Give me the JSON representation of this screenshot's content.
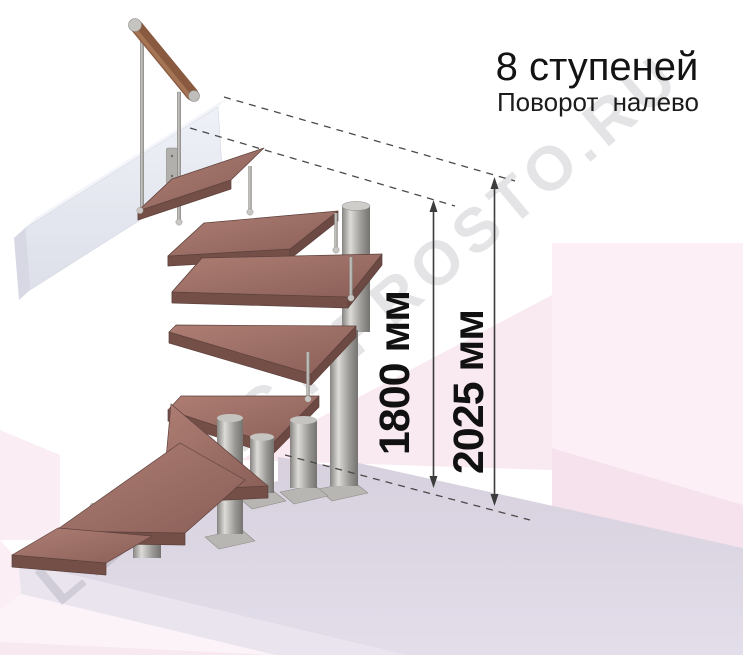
{
  "header": {
    "title": "8 ступеней",
    "subtitle": "Поворот налево"
  },
  "diagram": {
    "steps_shown": 8,
    "turn_direction": "налево",
    "dimensions": [
      {
        "id": "height-to-top-step",
        "label": "1800 мм"
      },
      {
        "id": "height-to-landing",
        "label": "2025 мм"
      }
    ]
  },
  "watermark": {
    "text": "LESTNICY-PROSTO.RU"
  },
  "colors": {
    "wood_top": "#9e7067",
    "wood_edge": "#744f48",
    "metal": "#a8a6a2",
    "landing_beam": "#e9eaf2",
    "floor_slab": "#dcd6e2",
    "background_pink": "#f8e7f0",
    "dimension_line": "#3c3c3c",
    "title_text": "#131313"
  }
}
